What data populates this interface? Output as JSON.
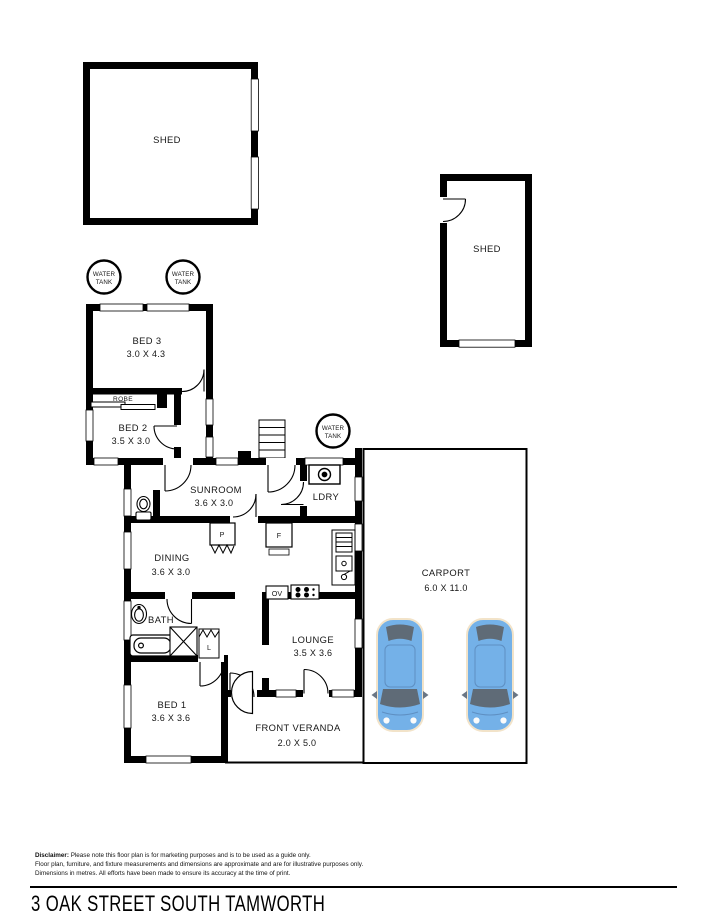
{
  "title": "3 OAK STREET SOUTH TAMWORTH",
  "disclaimer": {
    "label": "Disclaimer:",
    "line1_rest": " Please note this floor plan is for marketing purposes and is to be used as a guide only.",
    "line2": "Floor plan, furniture, and fixture measurements and dimensions are approximate and are for illustrative purposes only.",
    "line3": "Dimensions in metres. All efforts have been made to ensure its accuracy at the time of print."
  },
  "water_tank": {
    "line1": "WATER",
    "line2": "TANK"
  },
  "rooms": {
    "shed1": {
      "name": "SHED"
    },
    "shed2": {
      "name": "SHED"
    },
    "bed3": {
      "name": "BED 3",
      "dims": "3.0 X 4.3"
    },
    "robe": {
      "name": "ROBE"
    },
    "bed2": {
      "name": "BED 2",
      "dims": "3.5 X 3.0"
    },
    "sunroom": {
      "name": "SUNROOM",
      "dims": "3.6 X 3.0"
    },
    "ldry": {
      "name": "LDRY"
    },
    "dining": {
      "name": "DINING",
      "dims": "3.6 X 3.0"
    },
    "bath": {
      "name": "BATH"
    },
    "lounge": {
      "name": "LOUNGE",
      "dims": "3.5 X 3.6"
    },
    "bed1": {
      "name": "BED 1",
      "dims": "3.6 X 3.6"
    },
    "veranda": {
      "name": "FRONT VERANDA",
      "dims": "2.0 X 5.0"
    },
    "carport": {
      "name": "CARPORT",
      "dims": "6.0 X 11.0"
    }
  },
  "fixtures": {
    "pantry": "P",
    "fridge": "F",
    "linen": "L",
    "oven": "OV"
  },
  "colors": {
    "wall": "#000000",
    "background": "#ffffff",
    "car_body": "#74b1e8",
    "car_glass": "#5f6b77",
    "car_trim": "#f2e3c9"
  }
}
